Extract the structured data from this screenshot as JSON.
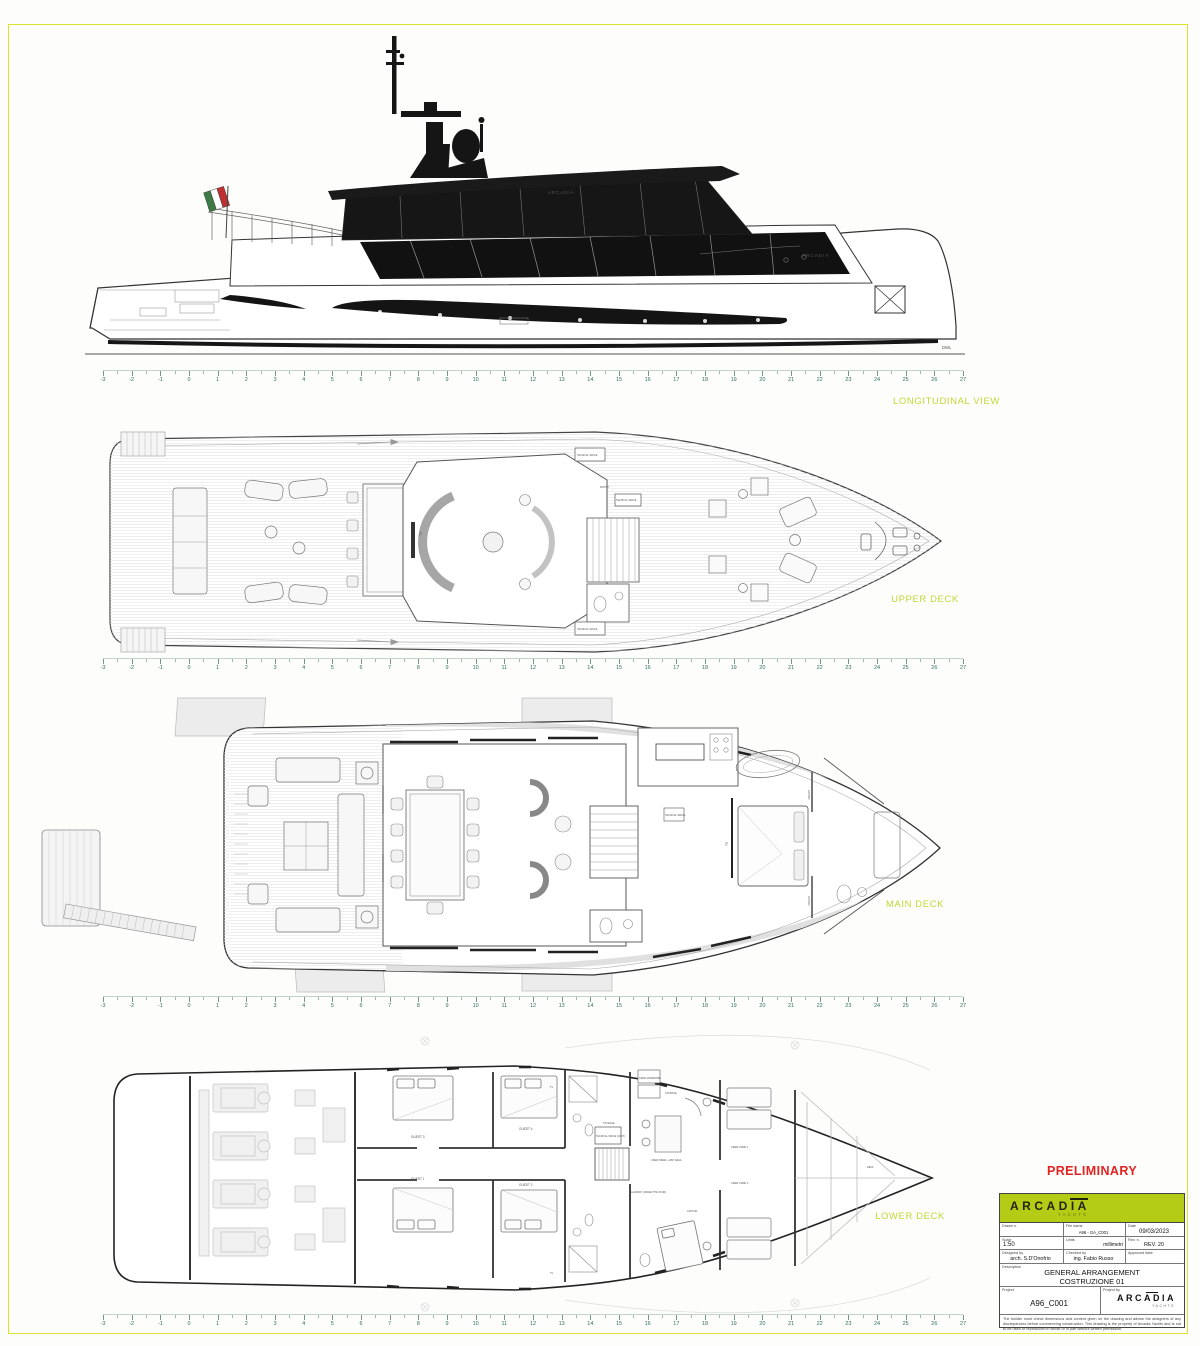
{
  "colors": {
    "accent_label": "#c3d836",
    "preliminary": "#e32222",
    "logo_band": "#b5cc16",
    "ruler_text": "#2f6f60",
    "page_border": "#dde22d"
  },
  "preliminary": "PRELIMINARY",
  "ruler": {
    "ticks": [
      -3,
      -2,
      -1,
      0,
      1,
      2,
      3,
      4,
      5,
      6,
      7,
      8,
      9,
      10,
      11,
      12,
      13,
      14,
      15,
      16,
      17,
      18,
      19,
      20,
      21,
      22,
      23,
      24,
      25,
      26,
      27
    ]
  },
  "views": {
    "longitudinal": {
      "label": "LONGITUDINAL VIEW",
      "dwl": "DWL",
      "brand_roof": "ARCADIA",
      "brand_bow": "ARCADIA"
    },
    "upper_deck": {
      "label": "UPPER DECK",
      "labels": {
        "tech_top": "TECNICAL SPACE",
        "tech_bottom": "TECNICAL SPACE",
        "tech_mid": "TECNICAL SPACE",
        "pantry": "PANTRY",
        "tv": "TV"
      }
    },
    "main_deck": {
      "label": "MAIN DECK",
      "labels": {
        "library_top": "LIBRARY",
        "library_bottom": "LIBRARY",
        "tv": "TV",
        "tech": "TECNICAL SPACE"
      }
    },
    "lower_deck": {
      "label": "LOWER DECK",
      "labels": {
        "guest3": "GUEST 3",
        "guest4": "GUEST 4",
        "guest1": "GUEST 1",
        "guest2": "GUEST 2",
        "crew_diner": "CREW DINER + WET AREA",
        "crew_cabin1": "CREW CABIN 1",
        "crew_cabin2": "CREW CABIN 2",
        "captain": "CAPTAIN",
        "storage1": "STORAGE",
        "storage2": "STORAGE",
        "laundry": "LAUNDRY (UNDER THE STAIR)",
        "tech_vent": "TECNICAL SPACE (VENT.)",
        "wardrobe": "CREW WARDROBE",
        "deck": "DECK",
        "tv1": "TV",
        "tv2": "TV"
      }
    }
  },
  "title_block": {
    "brand": "ARCADIA",
    "brand_sub": "YACHTS",
    "fields": {
      "drawn_label": "Drawn n.",
      "drawn": "",
      "filename_label": "File name",
      "filename": "A96 - GA_C001",
      "date_label": "Date",
      "date": "09/03/2023",
      "scale_label": "Scale",
      "scale": "1:50",
      "units_label": "Units",
      "units": "millimetri",
      "rev_label": "Rev. n.",
      "rev": "REV. 20",
      "designed_label": "Designed by",
      "designed": "arch. S.D'Onofrio",
      "checked_label": "Checked by",
      "checked": "ing. Fabio Russo",
      "approved_label": "Approved date",
      "approved": "",
      "description_label": "Description",
      "description_line1": "GENERAL ARRANGEMENT",
      "description_line2": "COSTRUZIONE 01",
      "project_label": "Project",
      "project": "A96_C001",
      "project_by_label": "Project by"
    },
    "disclaimer": "The builder must check dimensions and content given on the drawing and advise the designers of any discrepancies before commencing construction. This drawing is the property of Arcadia Yachts and is not to be used or reproduced in whole or in part without written permission."
  }
}
